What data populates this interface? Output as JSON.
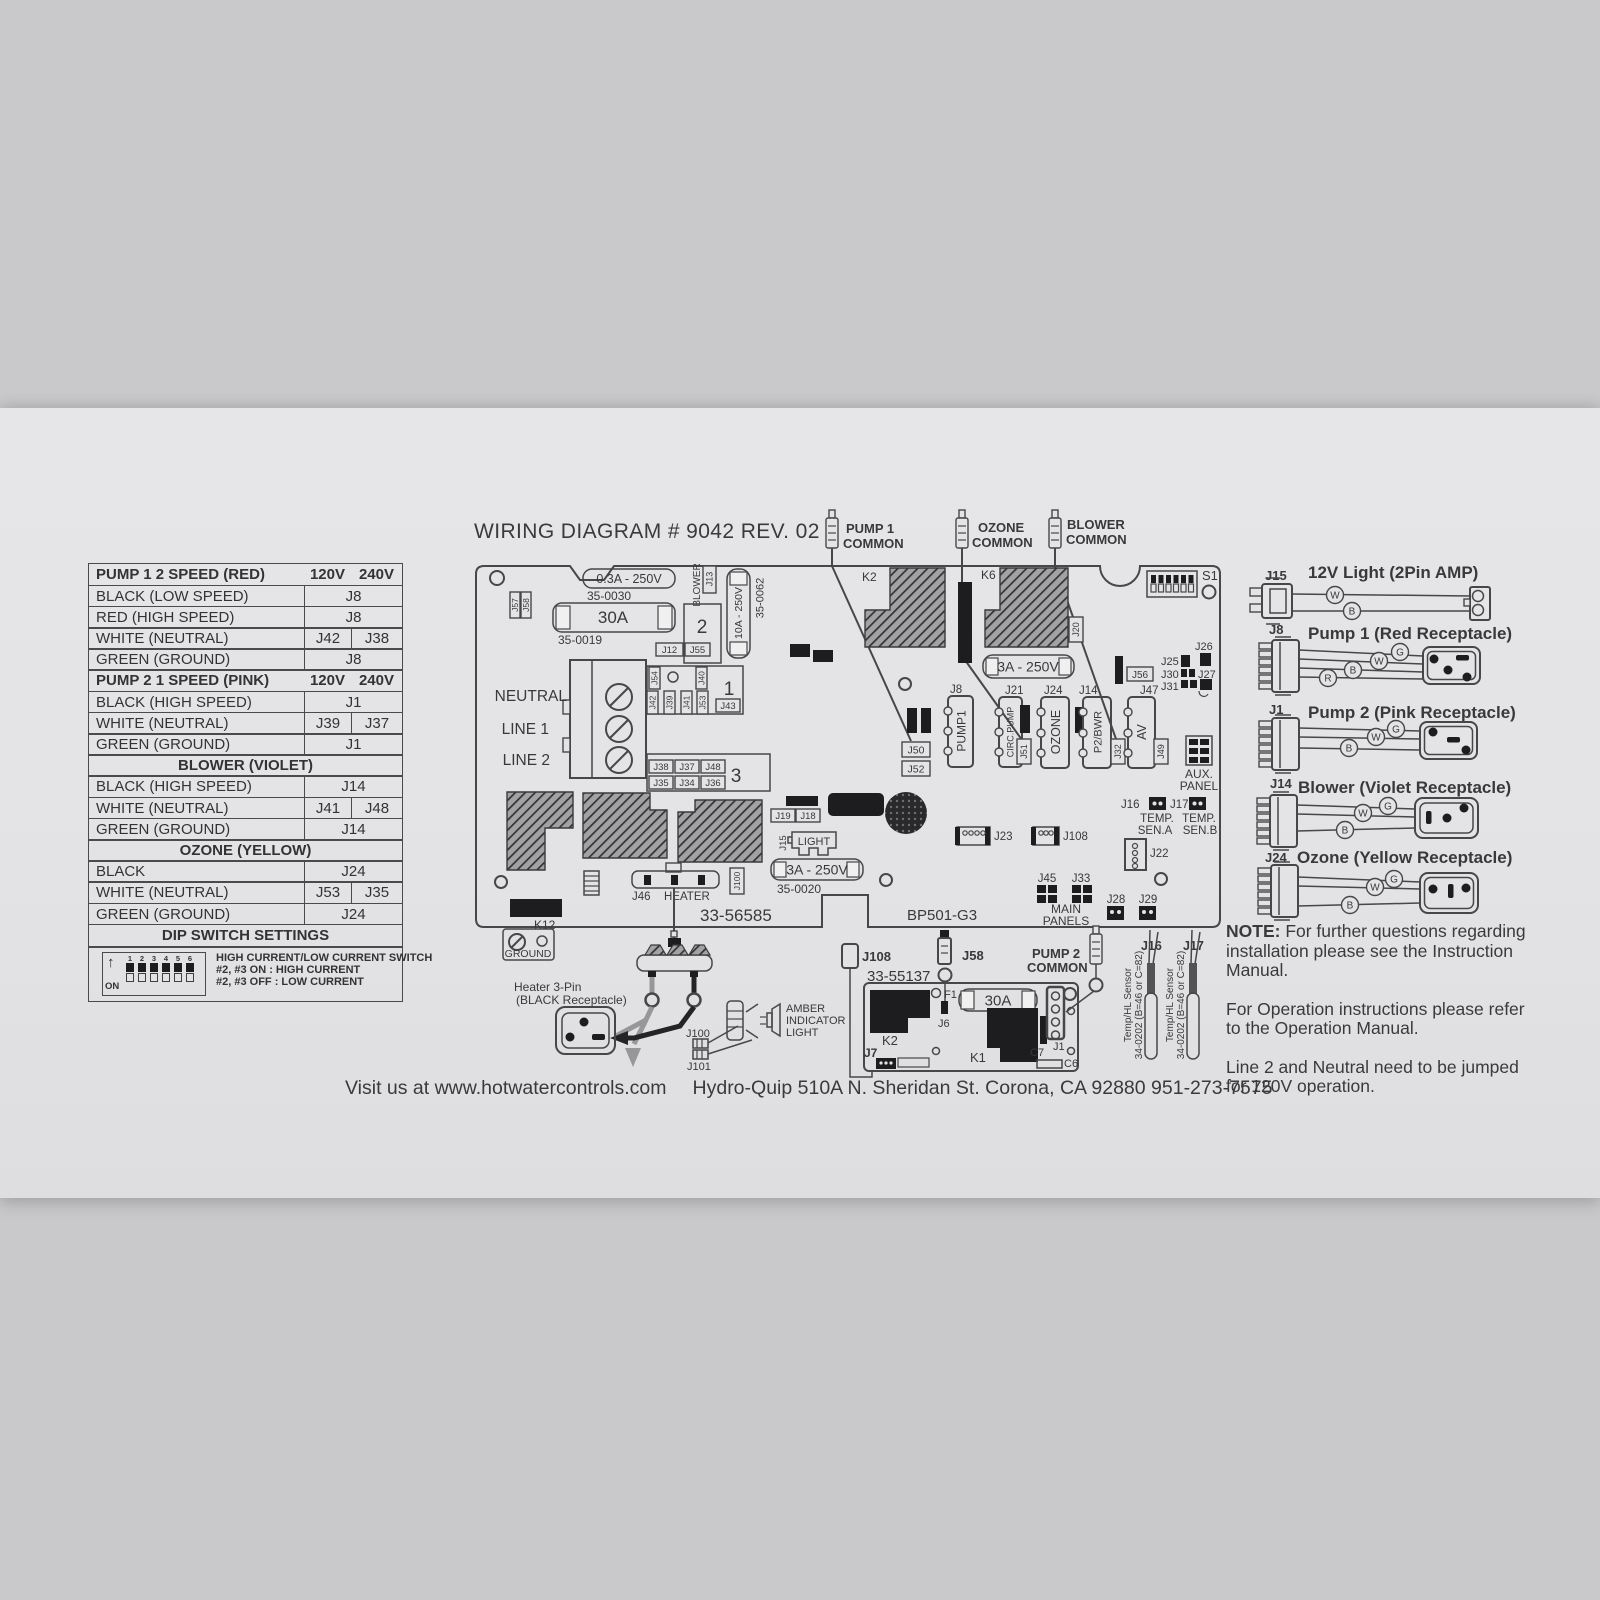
{
  "title": "WIRING DIAGRAM # 9042 REV. 02",
  "footer1": "Visit us at www.hotwatercontrols.com",
  "footer2": "Hydro-Quip 510A N. Sheridan St. Corona, CA 92880 951-273-7575",
  "colors": {
    "label_bg": "#e3e3e5",
    "line": "#47474a",
    "black_part": "#1d1d1f"
  },
  "table": {
    "rows": [
      {
        "label": "PUMP 1 2 SPEED (RED)",
        "v1": "120V",
        "v2": "240V"
      },
      {
        "label": "BLACK (LOW SPEED)",
        "value": "J8"
      },
      {
        "label": "RED (HIGH SPEED)",
        "value": "J8"
      },
      {
        "label": "WHITE (NEUTRAL)",
        "v1": "J42",
        "v2": "J38"
      },
      {
        "label": "GREEN (GROUND)",
        "value": "J8"
      },
      {
        "label": "PUMP 2 1 SPEED (PINK)",
        "v1": "120V",
        "v2": "240V"
      },
      {
        "label": "BLACK (HIGH SPEED)",
        "value": "J1"
      },
      {
        "label": "WHITE (NEUTRAL)",
        "v1": "J39",
        "v2": "J37"
      },
      {
        "label": "GREEN (GROUND)",
        "value": "J1"
      },
      {
        "label": "BLOWER (VIOLET)"
      },
      {
        "label": "BLACK (HIGH SPEED)",
        "value": "J14"
      },
      {
        "label": "WHITE (NEUTRAL)",
        "v1": "J41",
        "v2": "J48"
      },
      {
        "label": "GREEN (GROUND)",
        "value": "J14"
      },
      {
        "label": "OZONE (YELLOW)"
      },
      {
        "label": "BLACK",
        "value": "J24"
      },
      {
        "label": "WHITE (NEUTRAL)",
        "v1": "J53",
        "v2": "J35"
      },
      {
        "label": "GREEN (GROUND)",
        "value": "J24"
      },
      {
        "label": "DIP SWITCH SETTINGS"
      }
    ],
    "dip": {
      "arrow": "↑",
      "on": "ON",
      "n1": "1",
      "n2": "2",
      "n3": "3",
      "n4": "4",
      "n5": "5",
      "n6": "6",
      "l1": "HIGH CURRENT/LOW CURRENT SWITCH",
      "l2": "#2, #3 ON : HIGH CURRENT",
      "l3": "#2, #3 OFF : LOW CURRENT"
    }
  },
  "p": {
    "part_number": "33-56585",
    "model": "BP501-G3",
    "pump1a": "PUMP 1",
    "pump1b": "COMMON",
    "ozonea": "OZONE",
    "ozoneb": "COMMON",
    "blowera": "BLOWER",
    "blowerb": "COMMON",
    "neutral": "NEUTRAL",
    "line1": "LINE 1",
    "line2": "LINE 2",
    "f1": "0.3A - 250V",
    "f1p": "35-0030",
    "f2": "30A",
    "f2p": "35-0019",
    "f3": "10A - 250V",
    "f3p": "35-0062",
    "f4": "3A - 250V",
    "f5": "3A - 250V",
    "f5p": "35-0020",
    "k2": "K2",
    "k6": "K6",
    "k12": "K12",
    "s1": "S1",
    "g1": "1",
    "g2": "2",
    "g3": "3",
    "j57": "J57",
    "j58": "J58",
    "j13": "J13",
    "blower_vert": "BLOWER",
    "j12": "J12",
    "j55": "J55",
    "j54": "J54",
    "j40": "J40",
    "j42": "J42",
    "j39": "J39",
    "j41": "J41",
    "j53": "J53",
    "j43": "J43",
    "j38": "J38",
    "j37": "J37",
    "j48": "J48",
    "j35": "J35",
    "j34": "J34",
    "j36": "J36",
    "j50": "J50",
    "j52": "J52",
    "j20": "J20",
    "j8": "J8",
    "pump1": "PUMP1",
    "j21": "J21",
    "circpump": "CIRC.PUMP",
    "j51": "J51",
    "j24": "J24",
    "ozone": "OZONE",
    "j14": "J14",
    "p2bwr": "P2/BWR",
    "j32": "J32",
    "j47": "J47",
    "av": "AV",
    "j49": "J49",
    "j56": "J56",
    "j25": "J25",
    "j26": "J26",
    "j27": "J27",
    "j30": "J30",
    "j31": "J31",
    "aux1": "AUX.",
    "aux2": "PANEL",
    "j16": "J16",
    "j17": "J17",
    "tempa1": "TEMP.",
    "tempa2": "SEN.A",
    "tempb1": "TEMP.",
    "tempb2": "SEN.B",
    "j23": "J23",
    "j108": "J108",
    "j22": "J22",
    "j45": "J45",
    "j33": "J33",
    "main1": "MAIN",
    "main2": "PANELS",
    "j28": "J28",
    "j29": "J29",
    "j46": "J46",
    "heater": "HEATER",
    "j15": "J15",
    "light": "LIGHT",
    "j19": "J19",
    "j18": "J18",
    "ground": "GROUND",
    "heater1": "Heater 3-Pin",
    "heater2": "(BLACK Receptacle)",
    "j100": "J100",
    "j101": "J101",
    "amber1": "AMBER",
    "amber2": "INDICATOR",
    "amber3": "LIGHT"
  },
  "sb": {
    "number": "33-55137",
    "j108": "J108",
    "j58": "J58",
    "pump2a": "PUMP 2",
    "pump2b": "COMMON",
    "f1": "F1",
    "j6": "J6",
    "fuse": "30A",
    "k2": "K2",
    "k1": "K1",
    "c7": "C7",
    "c6": "C6",
    "j1": "J1",
    "j7": "J7"
  },
  "sen": {
    "j16": "J16",
    "j17": "J17",
    "line1": "Temp/HL Sensor",
    "line2": "34-0202 (B=46 or C=82)"
  },
  "legend": {
    "items": [
      {
        "jack": "J15",
        "title": "12V Light (2Pin AMP)",
        "w1": "W",
        "w2": "B"
      },
      {
        "jack": "J8",
        "title": "Pump 1 (Red Receptacle)",
        "w1": "G",
        "w2": "W",
        "w3": "B",
        "w4": "R"
      },
      {
        "jack": "J1",
        "title": "Pump 2 (Pink Receptacle)",
        "w1": "G",
        "w2": "W",
        "w3": "B"
      },
      {
        "jack": "J14",
        "title": "Blower (Violet Receptacle)",
        "w1": "G",
        "w2": "W",
        "w3": "B"
      },
      {
        "jack": "J24",
        "title": "Ozone (Yellow Receptacle)",
        "w1": "G",
        "w2": "W",
        "w3": "B"
      }
    ]
  },
  "notes": {
    "n1a": "NOTE:",
    "n1b": " For further questions regarding installation please see the Instruction Manual.",
    "n2": "For Operation instructions please refer to the Operation Manual.",
    "n3": "Line 2 and Neutral need to be jumped for 120V operation."
  }
}
